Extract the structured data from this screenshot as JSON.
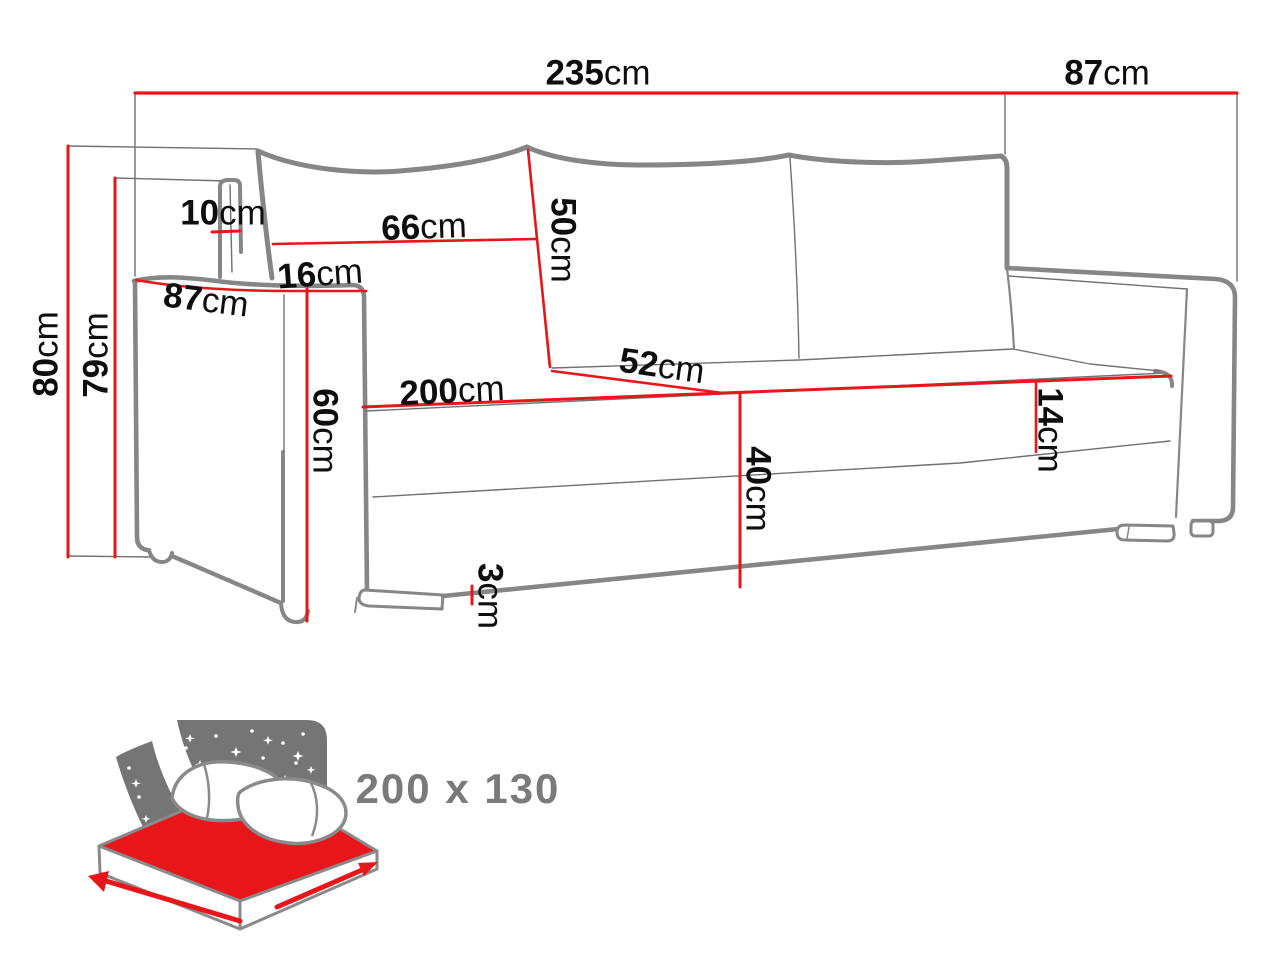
{
  "diagram": {
    "type": "sofa-dimension-drawing",
    "dimensions": {
      "total_width": {
        "value": "235",
        "unit": "cm"
      },
      "total_depth": {
        "value": "87",
        "unit": "cm"
      },
      "total_height": {
        "value": "80",
        "unit": "cm"
      },
      "frame_height": {
        "value": "79",
        "unit": "cm"
      },
      "back_post_width": {
        "value": "10",
        "unit": "cm"
      },
      "back_cushion_width": {
        "value": "66",
        "unit": "cm"
      },
      "back_cushion_height": {
        "value": "50",
        "unit": "cm"
      },
      "armrest_width": {
        "value": "16",
        "unit": "cm"
      },
      "armrest_depth": {
        "value": "87",
        "unit": "cm"
      },
      "armrest_height": {
        "value": "60",
        "unit": "cm"
      },
      "seat_width": {
        "value": "200",
        "unit": "cm"
      },
      "seat_depth": {
        "value": "52",
        "unit": "cm"
      },
      "seat_height": {
        "value": "40",
        "unit": "cm"
      },
      "seat_cushion_thickness": {
        "value": "14",
        "unit": "cm"
      },
      "ground_clearance": {
        "value": "3",
        "unit": "cm"
      }
    },
    "sleeping_area": {
      "label": "200 x 130"
    },
    "colors": {
      "dimension_red": "#e8151a",
      "outline_gray": "#868686",
      "thin_line_gray": "#707070",
      "icon_gray": "#757575",
      "label_black": "#0e0e0e",
      "sleeping_label_gray": "#7a7a7a"
    }
  }
}
